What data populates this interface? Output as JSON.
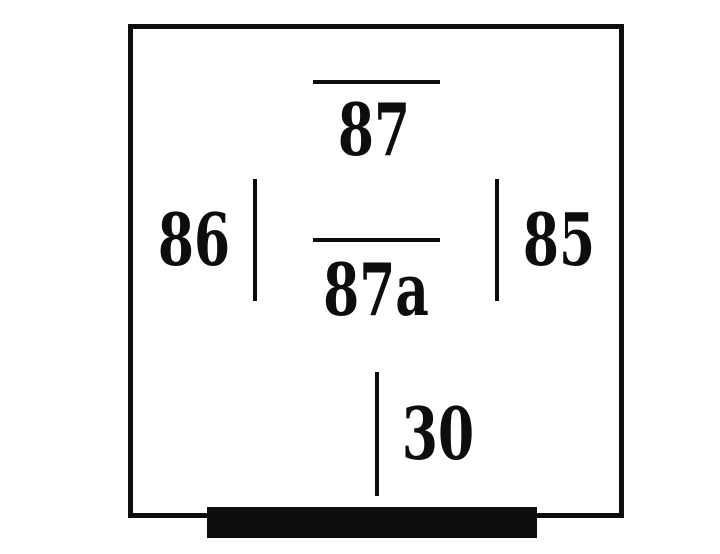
{
  "diagram": {
    "type": "relay-pinout-schematic",
    "pins": [
      {
        "id": "87",
        "label": "87",
        "position": "top-center",
        "marker": "horizontal-line"
      },
      {
        "id": "86",
        "label": "86",
        "position": "middle-left",
        "marker": "vertical-line"
      },
      {
        "id": "85",
        "label": "85",
        "position": "middle-right",
        "marker": "vertical-line"
      },
      {
        "id": "87a",
        "label": "87a",
        "position": "center",
        "marker": "horizontal-line"
      },
      {
        "id": "30",
        "label": "30",
        "position": "bottom-center",
        "marker": "vertical-line"
      }
    ]
  },
  "colors": {
    "ink": "#0d0d0d",
    "background": "#ffffff"
  }
}
